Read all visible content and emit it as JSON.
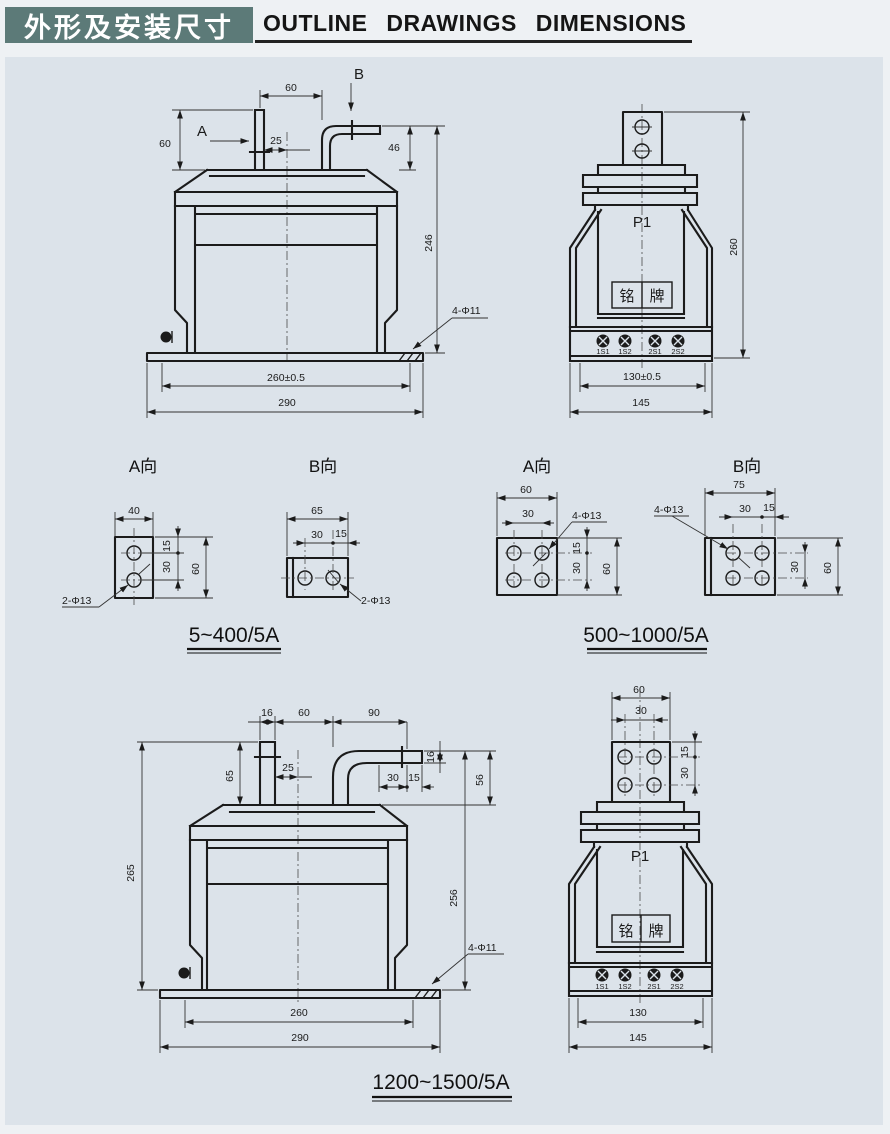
{
  "header": {
    "title_cn": "外形及安装尺寸",
    "title_en": "OUTLINE DRAWINGS DIMENSIONS"
  },
  "front_small": {
    "label_a": "A",
    "label_b": "B",
    "top_width": "60",
    "terminal_height": "60",
    "center_offset": "25",
    "bend_height": "46",
    "total_height": "246",
    "mount_holes": "4-Φ11",
    "mount_width": "260±0.5",
    "base_width": "290"
  },
  "side_small": {
    "height": "260",
    "primary_label": "P1",
    "nameplate_left": "铭",
    "nameplate_right": "牌",
    "terminal_1": "1S1",
    "terminal_2": "1S2",
    "terminal_3": "2S1",
    "terminal_4": "2S2",
    "mount_width": "130±0.5",
    "base_width": "145"
  },
  "views_small": {
    "title_a": "A向",
    "title_b": "B向",
    "a_width": "40",
    "a_edge": "15",
    "a_pitch": "30",
    "a_height": "60",
    "a_holes": "2-Φ13",
    "b_width": "65",
    "b_pitch": "30",
    "b_edge": "15",
    "b_holes": "2-Φ13",
    "caption": "5~400/5A"
  },
  "views_medium": {
    "title_a": "A向",
    "title_b": "B向",
    "a_width": "60",
    "a_pitch_x": "30",
    "a_holes": "4-Φ13",
    "a_edge": "15",
    "a_pitch_y": "30",
    "a_height": "60",
    "b_width": "75",
    "b_holes": "4-Φ13",
    "b_pitch_x": "30",
    "b_edge_x": "15",
    "b_pitch_y": "30",
    "b_height": "60",
    "caption": "500~1000/5A"
  },
  "front_large": {
    "bar_width": "16",
    "terminal_gap": "60",
    "arm_length": "90",
    "terminal_height": "65",
    "center_offset": "25",
    "hole_pitch": "30",
    "hole_edge": "15",
    "bar_thickness": "16",
    "bend_height": "56",
    "height_left": "265",
    "height_right": "256",
    "mount_holes": "4-Φ11",
    "mount_width": "260",
    "base_width": "290"
  },
  "side_large": {
    "plate_width": "60",
    "hole_pitch_x": "30",
    "hole_edge": "15",
    "hole_pitch_y": "30",
    "primary_label": "P1",
    "nameplate_left": "铭",
    "nameplate_right": "牌",
    "terminal_1": "1S1",
    "terminal_2": "1S2",
    "terminal_3": "2S1",
    "terminal_4": "2S2",
    "mount_width": "130",
    "base_width": "145"
  },
  "caption_large": "1200~1500/5A"
}
